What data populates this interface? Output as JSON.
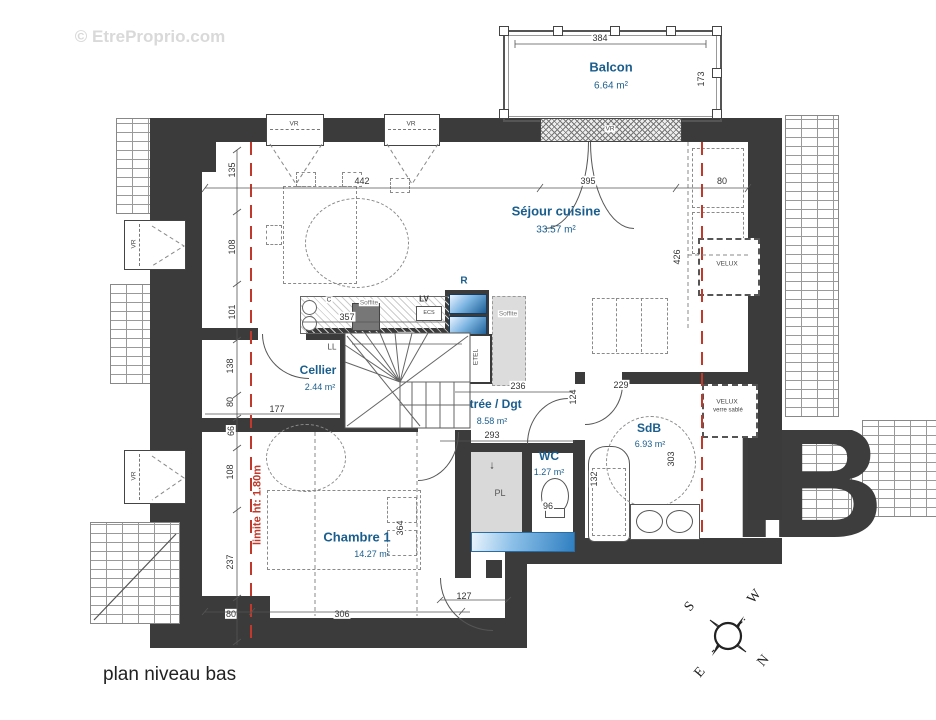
{
  "watermark": "© EtreProprio.com",
  "watermark_glyph": "IB",
  "plan_title": "plan niveau bas",
  "colors": {
    "wall": "#3b3b3b",
    "room_label": "#1a5e8e",
    "limit_red": "#c0392b",
    "glass_blue": "#2f7fc1"
  },
  "rooms": {
    "balcon": {
      "name": "Balcon",
      "area": "6.64 m²"
    },
    "sejour": {
      "name": "Séjour cuisine",
      "area": "33.57 m²"
    },
    "cellier": {
      "name": "Cellier",
      "area": "2.44 m²"
    },
    "entree": {
      "name": "Entrée / Dgt",
      "area": "8.58 m²"
    },
    "wc": {
      "name": "WC",
      "area": "1.27 m²"
    },
    "sdb": {
      "name": "SdB",
      "area": "6.93 m²"
    },
    "chambre": {
      "name": "Chambre 1",
      "area": "14.27 m²"
    }
  },
  "labels": {
    "vr": "VR",
    "r": "R",
    "lv": "LV",
    "ecs": "ECS",
    "ll": "LL",
    "c": "C",
    "pl": "PL",
    "soffite": "Soffite",
    "etel": "ETEL",
    "velux": "VELUX",
    "velux_sable_1": "VELUX",
    "velux_sable_2": "verre sablé",
    "limite": "limite ht: 1.80m",
    "arrow_down": "↓"
  },
  "dimensions": {
    "balcon_w": "384",
    "balcon_d": "173",
    "sejour_w": "442",
    "door_sejour": "395",
    "top_right": "80",
    "nook_h": "426",
    "left_1": "135",
    "left_2": "108",
    "left_3": "101",
    "left_4": "138",
    "left_5": "80",
    "left_6": "66",
    "left_7": "108",
    "left_8": "237",
    "bottom_left": "80",
    "chambre_w": "306",
    "door_bottom": "127",
    "kitchen": "357",
    "stairs_w": "218",
    "stairs_h": "90",
    "cellier_w": "177",
    "entree_w": "236",
    "entree_b": "293",
    "entree_h": "124",
    "wc_w": "96",
    "wc_h": "132",
    "sdb_w": "229",
    "sdb_h": "303",
    "chambre_h": "364"
  },
  "compass": {
    "n": "N",
    "s": "S",
    "e": "E",
    "w": "W"
  }
}
